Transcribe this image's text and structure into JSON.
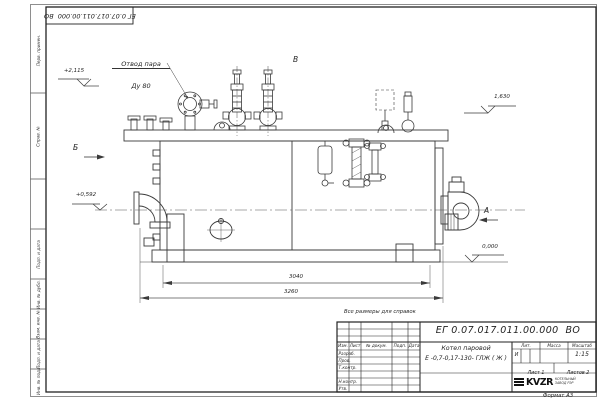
{
  "sheet": {
    "reference_note": "Все размеры для справок",
    "format_label": "Формат А3"
  },
  "drawing_labels": {
    "steam_outlet_line1": "Отвод пара",
    "steam_outlet_line2": "Ду 80",
    "elevation_top_left": "+2,115",
    "elevation_left": "+0,592",
    "elevation_right": "1,630",
    "elevation_base": "0,000",
    "view_a": "А",
    "view_b": "Б",
    "view_v": "В",
    "dim_supports": "3040",
    "dim_overall": "3260"
  },
  "title_block": {
    "doc_number": "ЕГ 0.07.017.011.00.000  ВО",
    "product_name_line1": "Котел паровой",
    "product_name_line2": "Е -0,7-0,17-130- ГЛЖ ( Ж )",
    "col_izm": "Изм.",
    "col_list": "Лист",
    "col_doc": "№ докум.",
    "col_podp": "Подп.",
    "col_data": "Дата",
    "row_razrab": "Разраб.",
    "row_prov": "Пров.",
    "row_tkontr": "Т.контр.",
    "row_nkontr": "Н.контр.",
    "row_utv": "Утв.",
    "lit_header": "Лит.",
    "mass_header": "Масса",
    "scale_header": "Масштаб",
    "lit_value": "И",
    "scale_value": "1:15",
    "sheet_label": "Лист",
    "sheet_value": "1",
    "sheets_label": "Листов",
    "sheets_value": "2",
    "company_logo": "KVZR",
    "company_line1": "КОТЕЛЬНЫЙ",
    "company_line2": "ЗАВОД РЭР"
  },
  "margin": {
    "cells": [
      "Перв. примен.",
      "Справ. №",
      "Подп. и дата",
      "Инв. № дубл.",
      "Взам. инв. №",
      "Подп. и дата",
      "Инв. № подл."
    ]
  }
}
